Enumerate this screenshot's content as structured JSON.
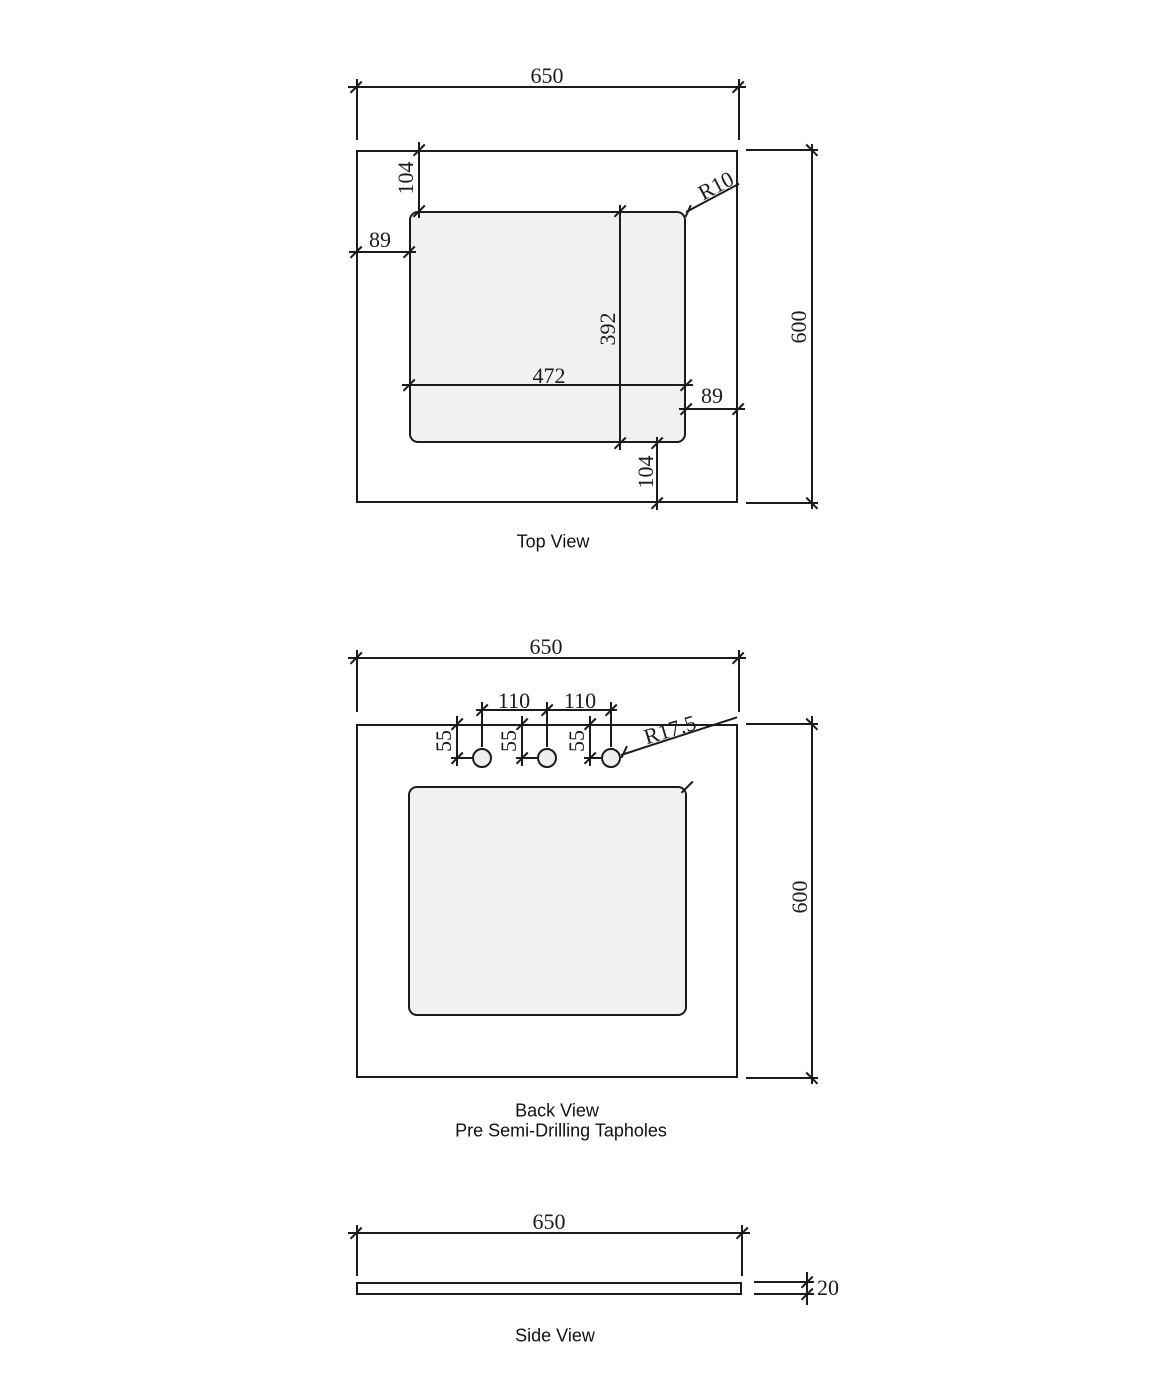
{
  "colors": {
    "line": "#1b1b1b",
    "cutout_fill": "#f1f1f1",
    "background": "#ffffff"
  },
  "views": {
    "top": {
      "label": "Top View",
      "dims": {
        "width": "650",
        "height": "600",
        "cutout_width": "472",
        "cutout_height": "392",
        "offset_left": "89",
        "offset_right": "89",
        "offset_top": "104",
        "offset_bottom": "104",
        "corner_radius": "R10"
      }
    },
    "back": {
      "label": "Back View",
      "sublabel": "Pre Semi-Drilling Tapholes",
      "dims": {
        "width": "650",
        "height": "600",
        "hole_spacing_left": "110",
        "hole_spacing_right": "110",
        "hole_offset_1": "55",
        "hole_offset_2": "55",
        "hole_offset_3": "55",
        "hole_radius": "R17.5"
      }
    },
    "side": {
      "label": "Side View",
      "dims": {
        "width": "650",
        "thickness": "20"
      }
    }
  }
}
